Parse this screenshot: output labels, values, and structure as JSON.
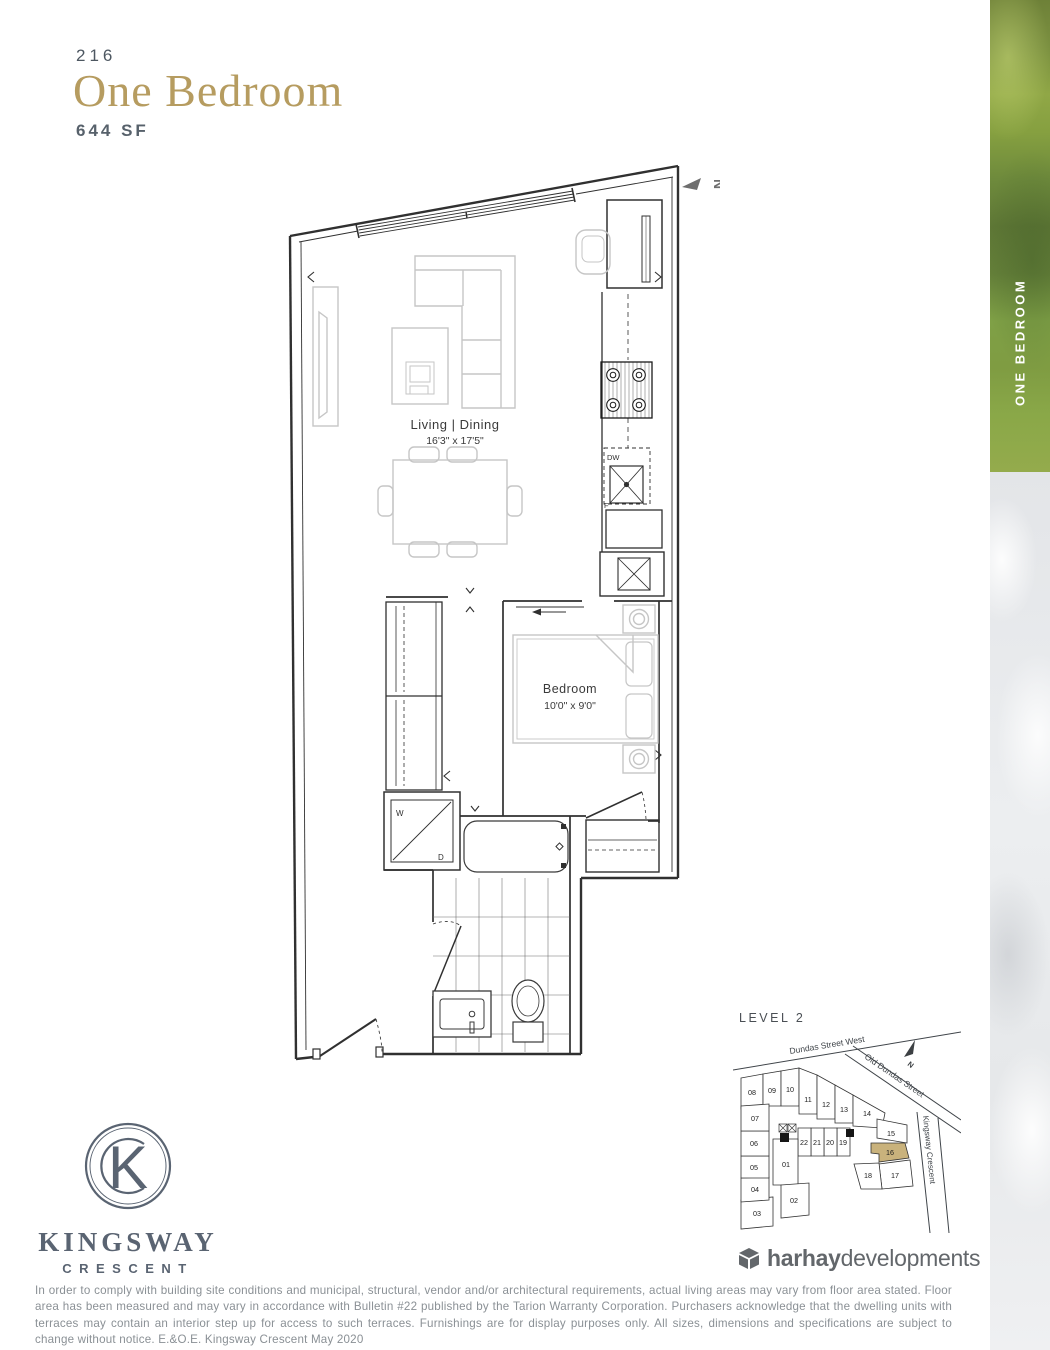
{
  "header": {
    "unit_number": "216",
    "title": "One Bedroom",
    "area": "644 SF"
  },
  "side_banner": {
    "label": "ONE BEDROOM"
  },
  "floorplan": {
    "living": {
      "name": "Living | Dining",
      "dims": "16'3\" x 17'5\""
    },
    "bedroom": {
      "name": "Bedroom",
      "dims": "10'0\" x 9'0\""
    },
    "labels": {
      "dishwasher": "DW",
      "fridge": "F",
      "washer": "W",
      "dryer": "D",
      "north": "N"
    }
  },
  "keyplan": {
    "title": "LEVEL 2",
    "streets": [
      "Dundas Street West",
      "Old Dundas Street",
      "Kingsway Crescent"
    ],
    "north": "N",
    "highlighted_unit": "16",
    "highlight_color": "#c9b27c",
    "units": [
      "08",
      "09",
      "10",
      "11",
      "12",
      "13",
      "14",
      "15",
      "16",
      "17",
      "18",
      "19",
      "20",
      "21",
      "22",
      "01",
      "02",
      "03",
      "04",
      "05",
      "06",
      "07"
    ]
  },
  "branding": {
    "logo_name": "KINGSWAY",
    "logo_sub": "CRESCENT",
    "monogram_letter": "K",
    "developer_bold": "harhay",
    "developer_light": "developments"
  },
  "disclaimer": "In order to comply with building site conditions and municipal, structural, vendor and/or architectural requirements, actual living areas may vary from floor area stated. Floor area has been measured and may vary in accordance with Bulletin #22 published by the Tarion Warranty Corporation. Purchasers acknowledge that the dwelling units with terraces may contain an interior step up for access to such terraces. Furnishings are for display purposes only. All sizes, dimensions and specifications are subject to change without notice. E.&O.E. Kingsway Crescent May 2020"
}
